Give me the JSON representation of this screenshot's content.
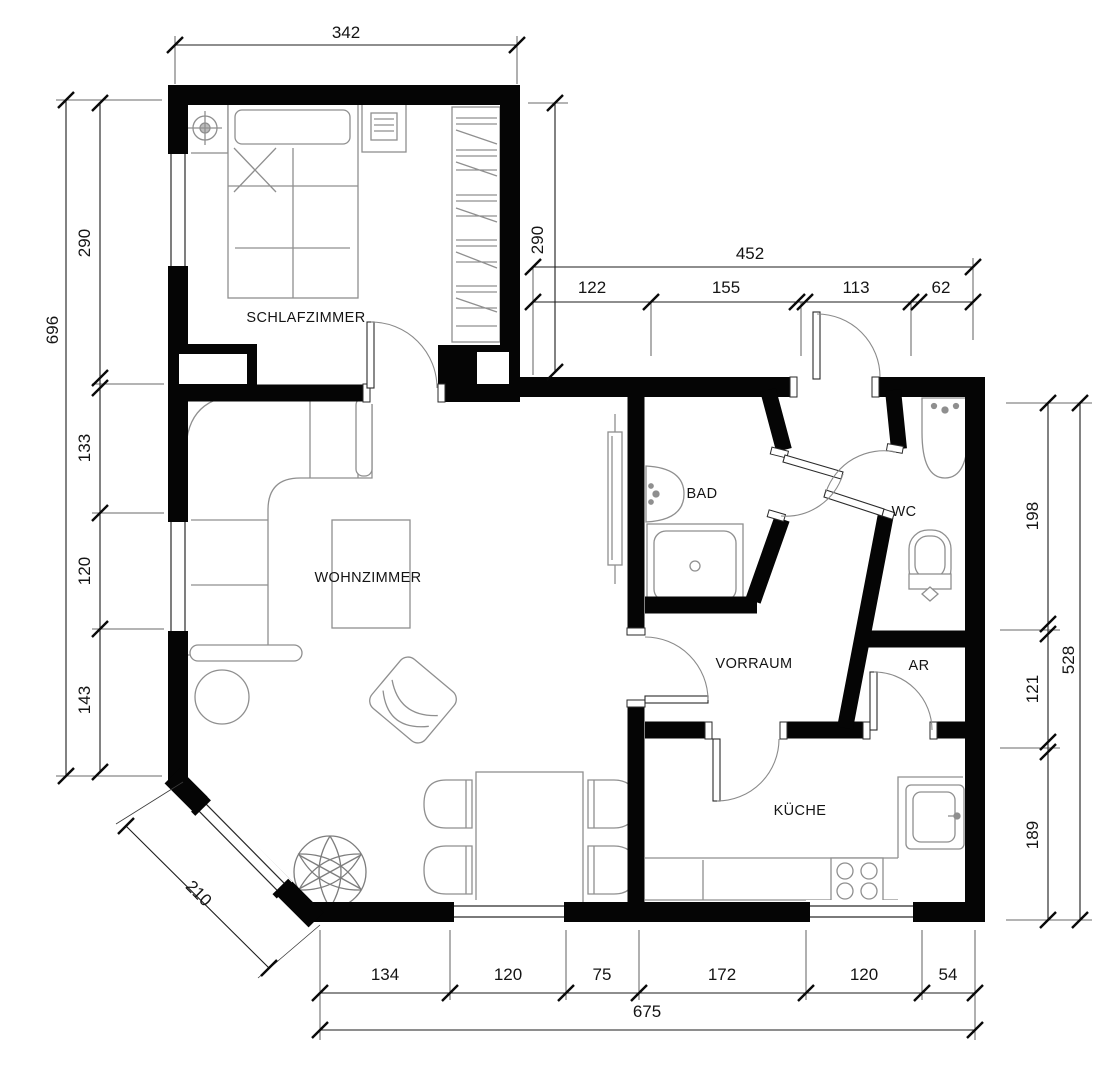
{
  "plan_type": "apartment-floor-plan",
  "colors": {
    "wall": "#050505",
    "furniture_outline": "#8f8f8f",
    "dimension_line": "#1c1c1c",
    "label_text": "#141414",
    "background": "#ffffff"
  },
  "rooms": [
    {
      "id": "schlafzimmer",
      "label": "SCHLAFZIMMER"
    },
    {
      "id": "wohnzimmer",
      "label": "WOHNZIMMER"
    },
    {
      "id": "bad",
      "label": "BAD"
    },
    {
      "id": "wc",
      "label": "WC"
    },
    {
      "id": "vorraum",
      "label": "VORRAUM"
    },
    {
      "id": "ar",
      "label": "AR"
    },
    {
      "id": "kueche",
      "label": "KÜCHE"
    }
  ],
  "dimensions": {
    "top": {
      "text": "342"
    },
    "left_total": {
      "text": "696"
    },
    "left_chain": [
      {
        "text": "290"
      },
      {
        "text": "133"
      },
      {
        "text": "120"
      },
      {
        "text": "143"
      }
    ],
    "diagonal": {
      "text": "210"
    },
    "closet_right": {
      "text": "290"
    },
    "upper_right_total": {
      "text": "452"
    },
    "upper_right_chain": [
      {
        "text": "122"
      },
      {
        "text": "155"
      },
      {
        "text": "113"
      },
      {
        "text": "62"
      }
    ],
    "right_chain": [
      {
        "text": "198"
      },
      {
        "text": "121"
      },
      {
        "text": "189"
      }
    ],
    "right_total": {
      "text": "528"
    },
    "bottom_chain": [
      {
        "text": "134"
      },
      {
        "text": "120"
      },
      {
        "text": "75"
      },
      {
        "text": "172"
      },
      {
        "text": "120"
      },
      {
        "text": "54"
      }
    ],
    "bottom_total": {
      "text": "675"
    }
  }
}
